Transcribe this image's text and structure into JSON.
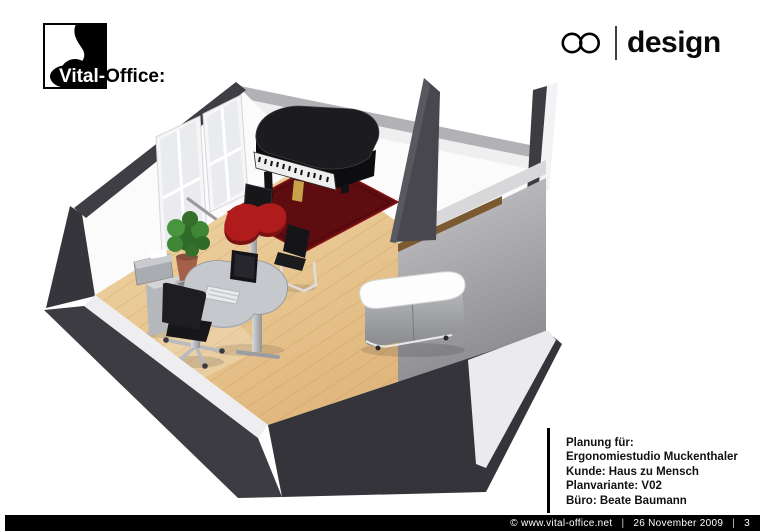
{
  "header": {
    "logo": {
      "brand_on_dark": "Vital-",
      "brand_on_light": "Office:"
    },
    "design_logo": {
      "label": "design"
    }
  },
  "scene": {
    "description": "3D rendering of an office room plan: grand piano on dark red rug, red organic side table, kidney-shaped desk with monitor and keyboard, office chair, cantilever chair, plant, printer stand, sideboard, interior partition room, windows with radiator, wooden floor"
  },
  "plan_info": {
    "lines": [
      "Planung für:",
      "Ergonomiestudio Muckenthaler",
      "Kunde: Haus zu Mensch",
      "Planvariante: V02",
      "Büro: Beate Baumann"
    ]
  },
  "footer": {
    "copyright": "© www.vital-office.net",
    "separator": "|",
    "date": "26 November 2009",
    "page": "3"
  },
  "colors": {
    "brand_black": "#000000",
    "floor_light": "#f1d9a9",
    "floor_dark": "#dcae72",
    "rug_red": "#5e0c10",
    "table_red": "#b01c1c",
    "wall_dark": "#3c3c42",
    "wood_rail": "#7b5a31",
    "footer_bg": "#000000",
    "footer_text": "#ffffff"
  }
}
